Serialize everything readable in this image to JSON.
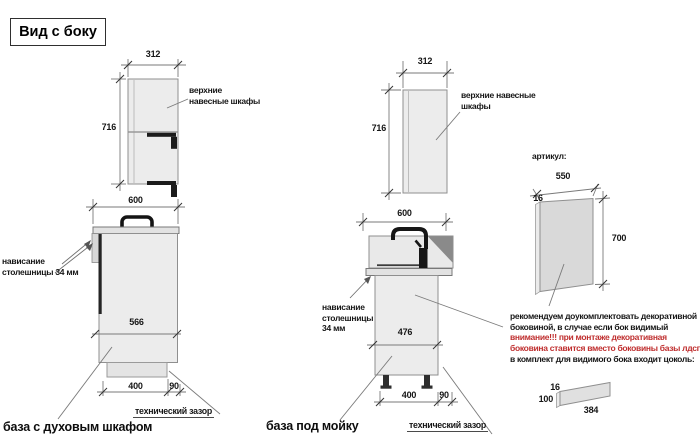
{
  "title": "Вид с боку",
  "palette": {
    "warning_red": "#bf2e2e",
    "cabinet_fill": "#ececec",
    "dark_fixture": "#1b1b1b"
  },
  "upper_cabinet_left": {
    "width_mm": "312",
    "height_mm": "716",
    "label": "верхние навесные шкафы"
  },
  "oven_base": {
    "width_mm": "600",
    "overhang_label": "нависание столешницы 34 мм",
    "depth_mm": "566",
    "plinth_mm": "400",
    "gap_mm": "90",
    "gap_label": "технический зазор",
    "caption": "база с духовым шкафом"
  },
  "upper_cabinet_mid": {
    "width_mm": "312",
    "height_mm": "716",
    "label": "верхние навесные шкафы"
  },
  "sink_base": {
    "width_mm": "600",
    "overhang_label": "нависание столешницы 34 мм",
    "depth_mm": "476",
    "plinth_mm": "400",
    "gap_mm": "90",
    "gap_label": "технический зазор",
    "caption": "база под мойку"
  },
  "decor_panel": {
    "article_label": "артикул:",
    "width_mm": "550",
    "thickness_mm": "16",
    "height_mm": "700",
    "note_lines": [
      {
        "text": "рекомендуем доукомплектовать декоративной",
        "warning": false
      },
      {
        "text": "боковиной, в случае если бок видимый",
        "warning": false
      },
      {
        "text": "внимание!!! при монтаже декоративная",
        "warning": true
      },
      {
        "text": "боковина ставится вместо боковины базы лдсп",
        "warning": true
      },
      {
        "text": "в комплект для видимого бока входит цоколь:",
        "warning": false
      }
    ]
  },
  "plinth_panel": {
    "thickness_mm": "16",
    "height_mm": "100",
    "length_mm": "384"
  }
}
